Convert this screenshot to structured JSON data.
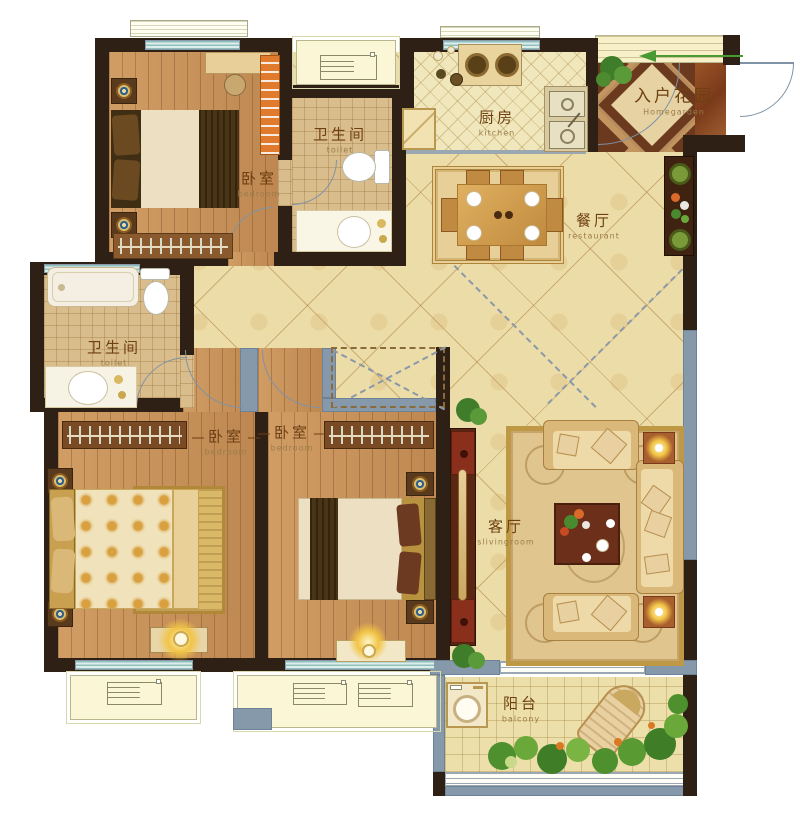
{
  "rooms": {
    "bedroom_top": {
      "name": "卧室",
      "sub": "bedroom"
    },
    "toilet_top": {
      "name": "卫生间",
      "sub": "toilet"
    },
    "kitchen": {
      "name": "厨房",
      "sub": "kitchen"
    },
    "homegarden": {
      "name": "入户花园",
      "sub": "Homegarden"
    },
    "dining": {
      "name": "餐厅",
      "sub": "restaurant"
    },
    "toilet_left": {
      "name": "卫生间",
      "sub": "toilet"
    },
    "bedroom_left": {
      "name": "卧室",
      "sub": "bedroom"
    },
    "bedroom_mid": {
      "name": "卧室",
      "sub": "bedroom"
    },
    "living": {
      "name": "客厅",
      "sub": "slivingroom"
    },
    "balcony": {
      "name": "阳台",
      "sub": "balcony"
    }
  },
  "colors": {
    "wall": "#2e2014",
    "window": "#8699ab",
    "hall_floor": "#ecdca8",
    "wood_floor": "#c8925a",
    "entry_marble_dark": "#6b3a1e",
    "arrow_green": "#4a9a33"
  }
}
